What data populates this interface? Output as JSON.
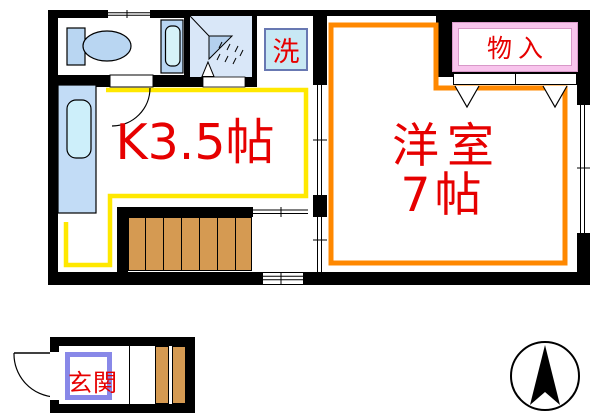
{
  "floorplan": {
    "rooms": {
      "kitchen": {
        "label": "K3.5帖",
        "outline_color": "#ffe800"
      },
      "western": {
        "label1": "洋室",
        "label2": "7帖",
        "outline_color": "#ff8800"
      },
      "closet": {
        "label": "物入",
        "border_color": "#f8c4ec"
      },
      "laundry": {
        "label": "洗",
        "fill_color": "#c8e8f4",
        "border_color": "#6878b2"
      },
      "entrance": {
        "label": "玄関",
        "border_color": "#8888e8"
      }
    },
    "fixtures": [
      "toilet",
      "washbasin",
      "shower",
      "bathtub",
      "stairs",
      "entrance-steps"
    ],
    "symbols": [
      "window",
      "sliding-door",
      "door-arc",
      "closet-door-triangles",
      "north-arrow"
    ],
    "colors": {
      "wall": "#000000",
      "label_text": "#e60000",
      "stairs": "#d59a52",
      "fixture_blue": "#b9d6f2",
      "fixture_inner_blue": "#cdeffa",
      "shower_room_bg": "#d9e7f8"
    }
  }
}
